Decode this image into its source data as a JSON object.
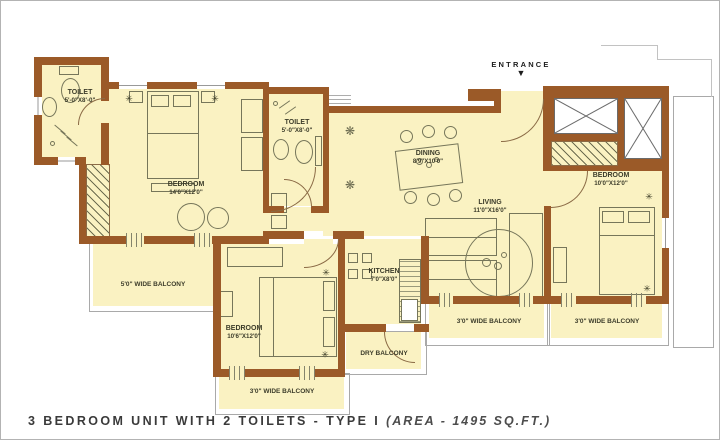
{
  "title": {
    "main": "3 BEDROOM UNIT WITH 2 TOILETS - TYPE I",
    "area": "(AREA - 1495 SQ.FT.)"
  },
  "entrance": {
    "label": "ENTRANCE",
    "arrow": "▼"
  },
  "rooms": {
    "toilet1": {
      "name": "TOILET",
      "dims": "5'-0\"X8'-0\""
    },
    "bedroom1": {
      "name": "BEDROOM",
      "dims": "14'0\"X12'0\""
    },
    "toilet2": {
      "name": "TOILET",
      "dims": "5'-0\"X8'-0\""
    },
    "dining": {
      "name": "DINING",
      "dims": "8'9\"X10'0\""
    },
    "living": {
      "name": "LIVING",
      "dims": "11'0\"X16'0\""
    },
    "kitchen": {
      "name": "KITCHEN",
      "dims": "7'0\"X8'0\""
    },
    "bedroom2": {
      "name": "BEDROOM",
      "dims": "10'6\"X12'0\""
    },
    "bedroom3": {
      "name": "BEDROOM",
      "dims": "10'0\"X12'0\""
    }
  },
  "balconies": {
    "left": "5'0\" WIDE BALCONY",
    "bottom": "3'0\" WIDE BALCONY",
    "living_side": "3'0\" WIDE BALCONY",
    "bedroom3_side": "3'0\" WIDE BALCONY",
    "dry": "DRY BALCONY"
  },
  "icons": {
    "light": "✳",
    "flower": "❋"
  },
  "colors": {
    "wall": "#9b5a28",
    "floor": "#faf2c2",
    "furniture_line": "#76765a",
    "label_text": "#3c3c2a",
    "title_text": "#3a3a3a"
  }
}
